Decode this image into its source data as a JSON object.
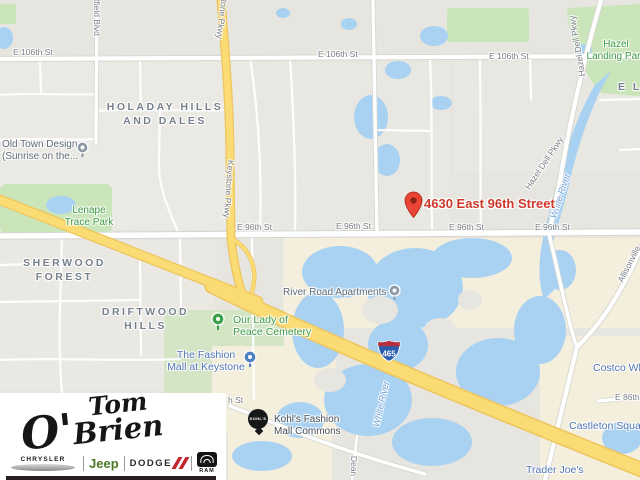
{
  "map": {
    "address": "4630 East 96th Street",
    "shield": "465",
    "streets": {
      "e106_1": "E 106th St",
      "e106_2": "E 106th St",
      "e106_3": "E 106th St",
      "e96_1": "E 96th St",
      "e96_2": "E 96th St",
      "e96_3": "E 96th St",
      "e96_4": "E 96th St",
      "e86": "E 86th St",
      "stub": "h St"
    },
    "roads": {
      "keystone_top": "Keystone Pkwy",
      "keystone_mid": "Keystone Pkwy",
      "westfield": "Westfield Blvd",
      "hazel_dell_top": "Hazel Dell Pkwy",
      "hazel_dell_mid": "Hazel Dell Pkwy",
      "allisonville": "Allisonville",
      "dean": "Dean"
    },
    "water": {
      "white_river_1": "White River",
      "white_river_2": "White River"
    },
    "neighborhoods": {
      "holaday_1": "HOLADAY HILLS",
      "holaday_2": "AND DALES",
      "sherwood_1": "SHERWOOD",
      "sherwood_2": "FOREST",
      "driftwood_1": "DRIFTWOOD",
      "driftwood_2": "HILLS",
      "partial_el": "E L"
    },
    "parks": {
      "lenape_1": "Lenape",
      "lenape_2": "Trace Park",
      "hazel_landing_1": "Hazel",
      "hazel_landing_2": "Landing Park"
    },
    "pois": {
      "old_town_1": "Old Town Design",
      "old_town_2": "(Sunrise on the...",
      "cemetery_1": "Our Lady of",
      "cemetery_2": "Peace Cemetery",
      "fashion_mall_1": "The Fashion",
      "fashion_mall_2": "Mall at Keystone",
      "river_road": "River Road Apartments",
      "kohls_1": "Kohl's Fashion",
      "kohls_2": "Mall Commons",
      "kohls_badge": "KOHL'S",
      "costco": "Costco Wh",
      "castleton": "Castleton Squa",
      "trader_joes": "Trader Joe's"
    }
  },
  "logo": {
    "script_line1": "Tom",
    "script_line2": "O'Brien",
    "chrysler": "CHRYSLER",
    "jeep": "Jeep",
    "dodge": "DODGE",
    "ram": "RAM"
  },
  "colors": {
    "marker_red": "#e94335",
    "address_red": "#ce382b",
    "water_blue": "#a9d2f2",
    "park_green": "#cbe5ba",
    "highway_yellow": "#fbdb74",
    "poi_blue": "#5076b5"
  }
}
